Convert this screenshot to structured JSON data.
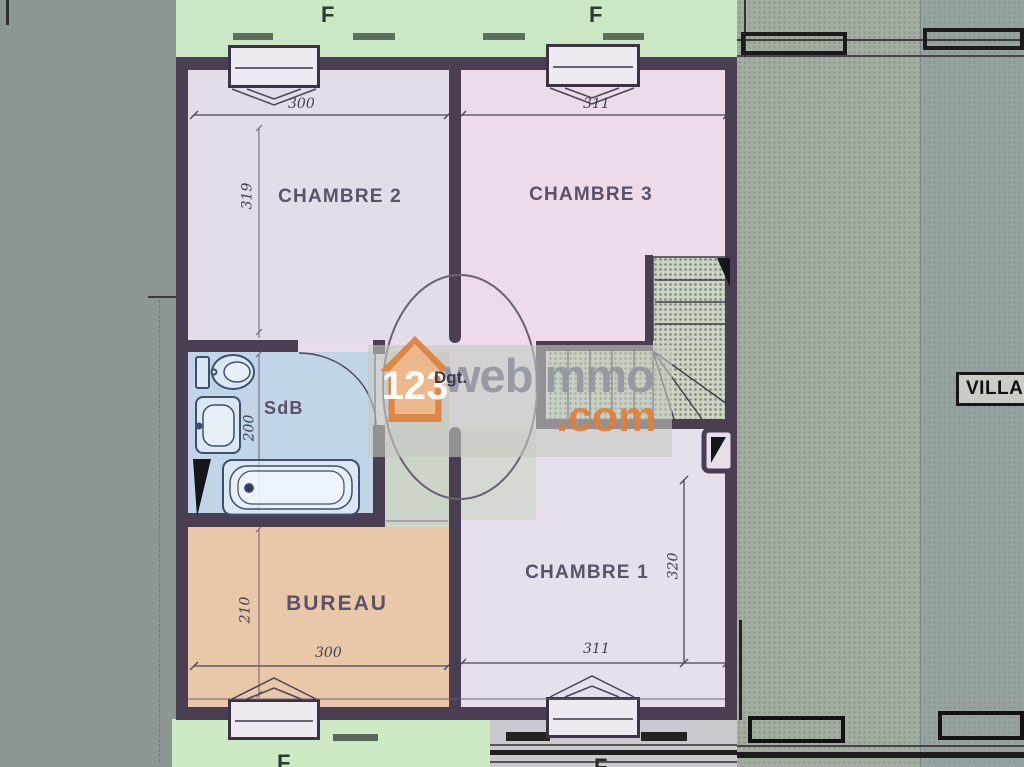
{
  "plan": {
    "f_top_left": "F",
    "f_top_right": "F",
    "f_bottom_left": "F",
    "f_bottom_right": "F",
    "rooms": {
      "chambre2": {
        "name": "CHAMBRE 2",
        "width_cm": "300",
        "height_cm": "319"
      },
      "chambre3": {
        "name": "CHAMBRE 3",
        "width_cm": "311"
      },
      "chambre1": {
        "name": "CHAMBRE 1",
        "width_cm": "311",
        "height_cm": "320"
      },
      "bureau": {
        "name": "BUREAU",
        "width_cm": "300",
        "height_cm": "210"
      },
      "sdb": {
        "name": "SdB",
        "height_cm": "200"
      },
      "dgt": {
        "name": "Dgt."
      }
    },
    "adjacent": {
      "villa_label": "VILLA"
    }
  },
  "watermark": {
    "number": "123",
    "brand": "webimmo",
    "tld": ".com",
    "orange": "#de823e",
    "grey": "#9496a0"
  },
  "colors": {
    "bedroom_fill": "#e8ddeb",
    "bathroom_fill": "#c1d4e8",
    "office_fill": "#e9c7a9",
    "garden_strip": "#cbe7c5",
    "wall": "#493e52",
    "masked_unit": "#a4ada1"
  }
}
